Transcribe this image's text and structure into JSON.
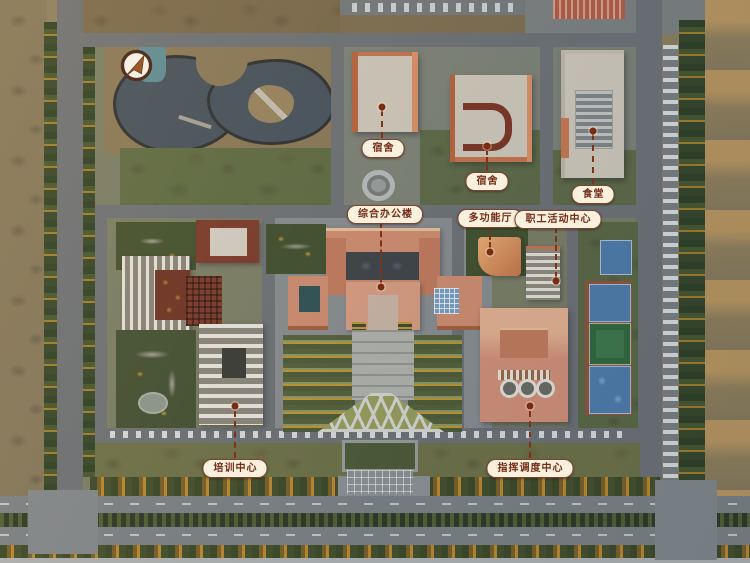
{
  "map": {
    "type": "aerial-campus-photo",
    "labels": [
      {
        "id": "dormitory-1",
        "text": "宿舍"
      },
      {
        "id": "dormitory-2",
        "text": "宿舍"
      },
      {
        "id": "canteen",
        "text": "食堂"
      },
      {
        "id": "office-building",
        "text": "综合办公楼"
      },
      {
        "id": "multifunction-hall",
        "text": "多功能厅"
      },
      {
        "id": "staff-activity-center",
        "text": "职工活动中心"
      },
      {
        "id": "training-center",
        "text": "培训中心"
      },
      {
        "id": "dispatch-center",
        "text": "指挥调度中心"
      }
    ],
    "icons": {
      "compass": "north-arrow-icon"
    },
    "colors": {
      "label_background": "#f9f1dd",
      "label_border": "#7d452f",
      "label_text": "#732c18",
      "leader_line": "#7d3318",
      "water": "#46545f",
      "building_salmon": "#d6937a",
      "court_blue": "#4f7fae",
      "court_green": "#3f7a4e"
    }
  }
}
